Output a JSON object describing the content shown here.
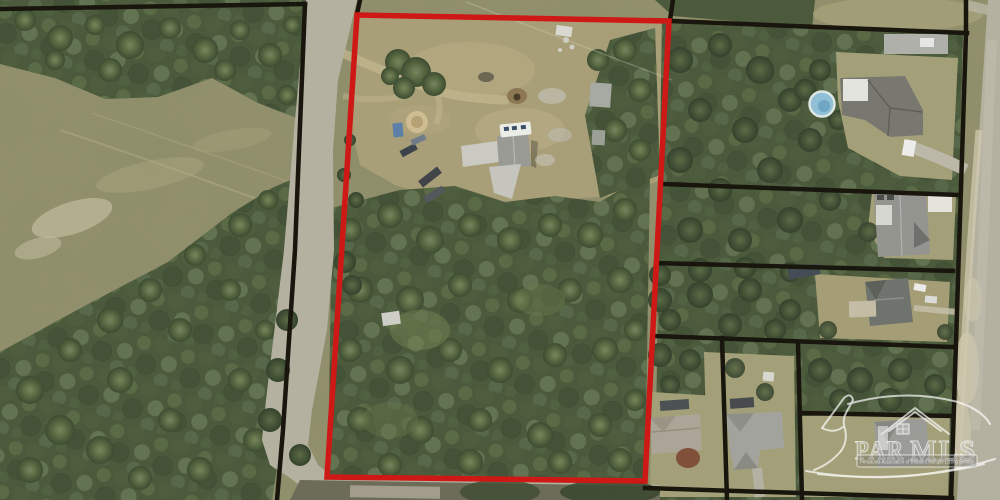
{
  "watermark": {
    "brand_left": "PAR",
    "brand_right": "MLS",
    "tagline": "Pensacola Association of Realtors Multiple Listing Service",
    "logo_icon": "pelican-house-logo"
  },
  "colors": {
    "highlight": "#cf1512",
    "boundary": "#15120a",
    "field": "#93906c",
    "clearing": "#a89e76",
    "forest": "#4a583a",
    "lawn": "#a3a078",
    "road": "#b5b1a0",
    "sand": "#cfc8ac",
    "pool": "#8fc0d8",
    "watermark": "#ffffff"
  }
}
